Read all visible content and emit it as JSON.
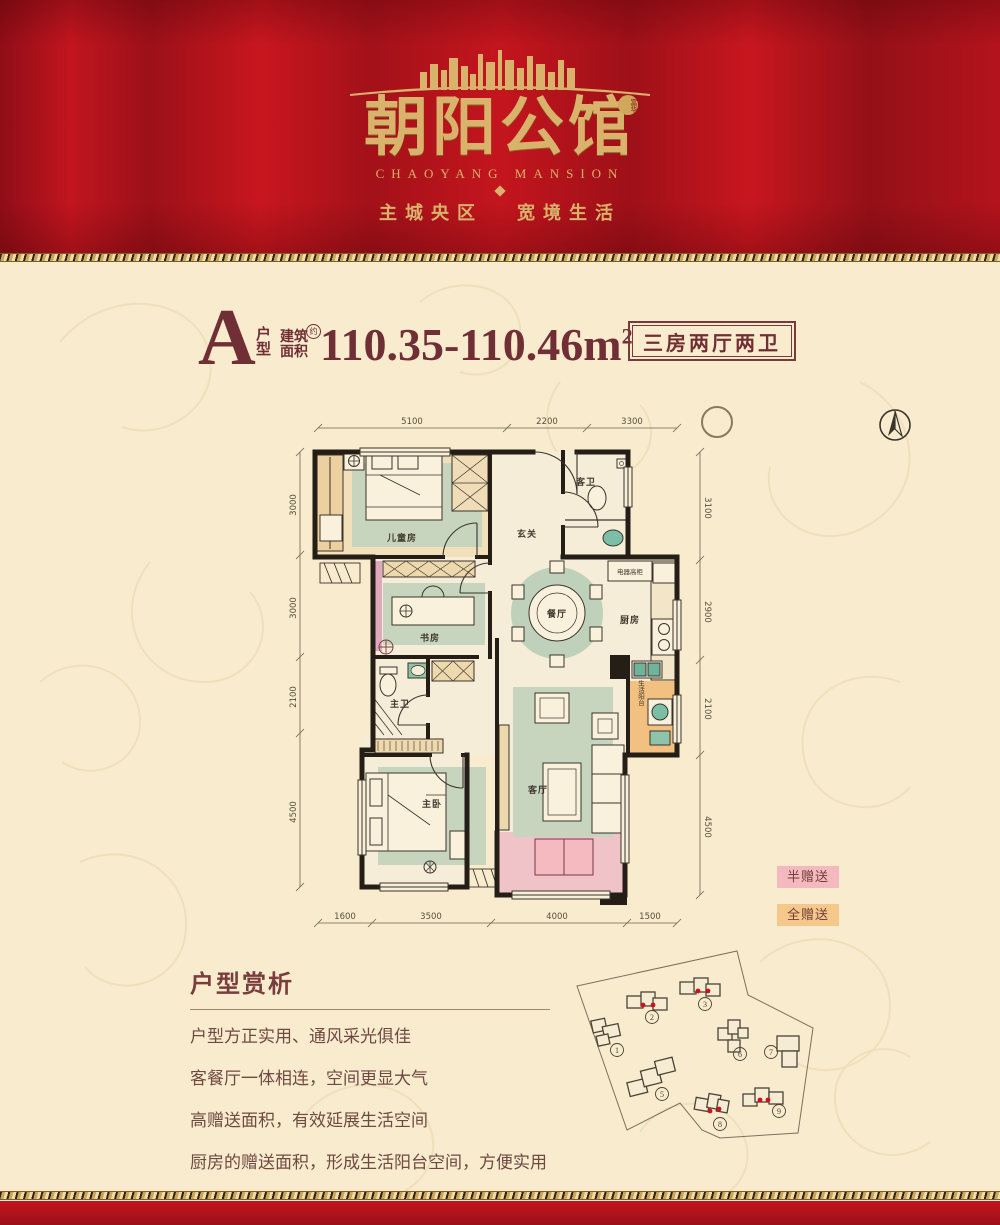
{
  "colors": {
    "banner_red": "#b5131f",
    "gold": "#d9b26b",
    "maroon": "#702f35",
    "legend_half_pink": "#f3b9be",
    "legend_full_orange": "#f5c78a",
    "wall_black": "#241e16",
    "rug_green": "#c7d5bf",
    "balcony_pink": "#efc3c8",
    "gift_orange": "#f2c181"
  },
  "header": {
    "title": "朝阳公馆",
    "seal": "富华",
    "subtitle": "CHAOYANG MANSION",
    "slogan_left": "主城央区",
    "slogan_right": "宽境生活"
  },
  "unit": {
    "letter": "A",
    "type_label": "户型",
    "area_label": "建筑\n面积",
    "approx": "约",
    "area_value": "110.35-110.46m",
    "area_sup": "2",
    "badge": "三房两厅两卫"
  },
  "floorplan": {
    "rooms": {
      "children": "儿童房",
      "study": "书房",
      "master_bath": "主卫",
      "master_bed": "主卧",
      "foyer": "玄关",
      "guest_bath": "客卫",
      "dining": "餐厅",
      "kitchen": "厨房",
      "living": "客厅",
      "life_balcony": "生活阳台",
      "cabinet": "电器高柜"
    },
    "dims_top": [
      "5100",
      "2200",
      "3300"
    ],
    "dims_bottom": [
      "1600",
      "3500",
      "4000",
      "1500"
    ],
    "dims_left": [
      "3000",
      "3000",
      "2100",
      "4500"
    ],
    "dims_right": [
      "3100",
      "2900",
      "2100",
      "4500"
    ]
  },
  "legend": {
    "half": "半赠送",
    "full": "全赠送"
  },
  "analysis": {
    "title": "户型赏析",
    "lines": [
      "户型方正实用、通风采光俱佳",
      "客餐厅一体相连，空间更显大气",
      "高赠送面积，有效延展生活空间",
      "厨房的赠送面积，形成生活阳台空间，方便实用"
    ]
  },
  "siteplan": {
    "numbers": [
      "1",
      "2",
      "3",
      "5",
      "6",
      "7",
      "8",
      "9"
    ]
  }
}
